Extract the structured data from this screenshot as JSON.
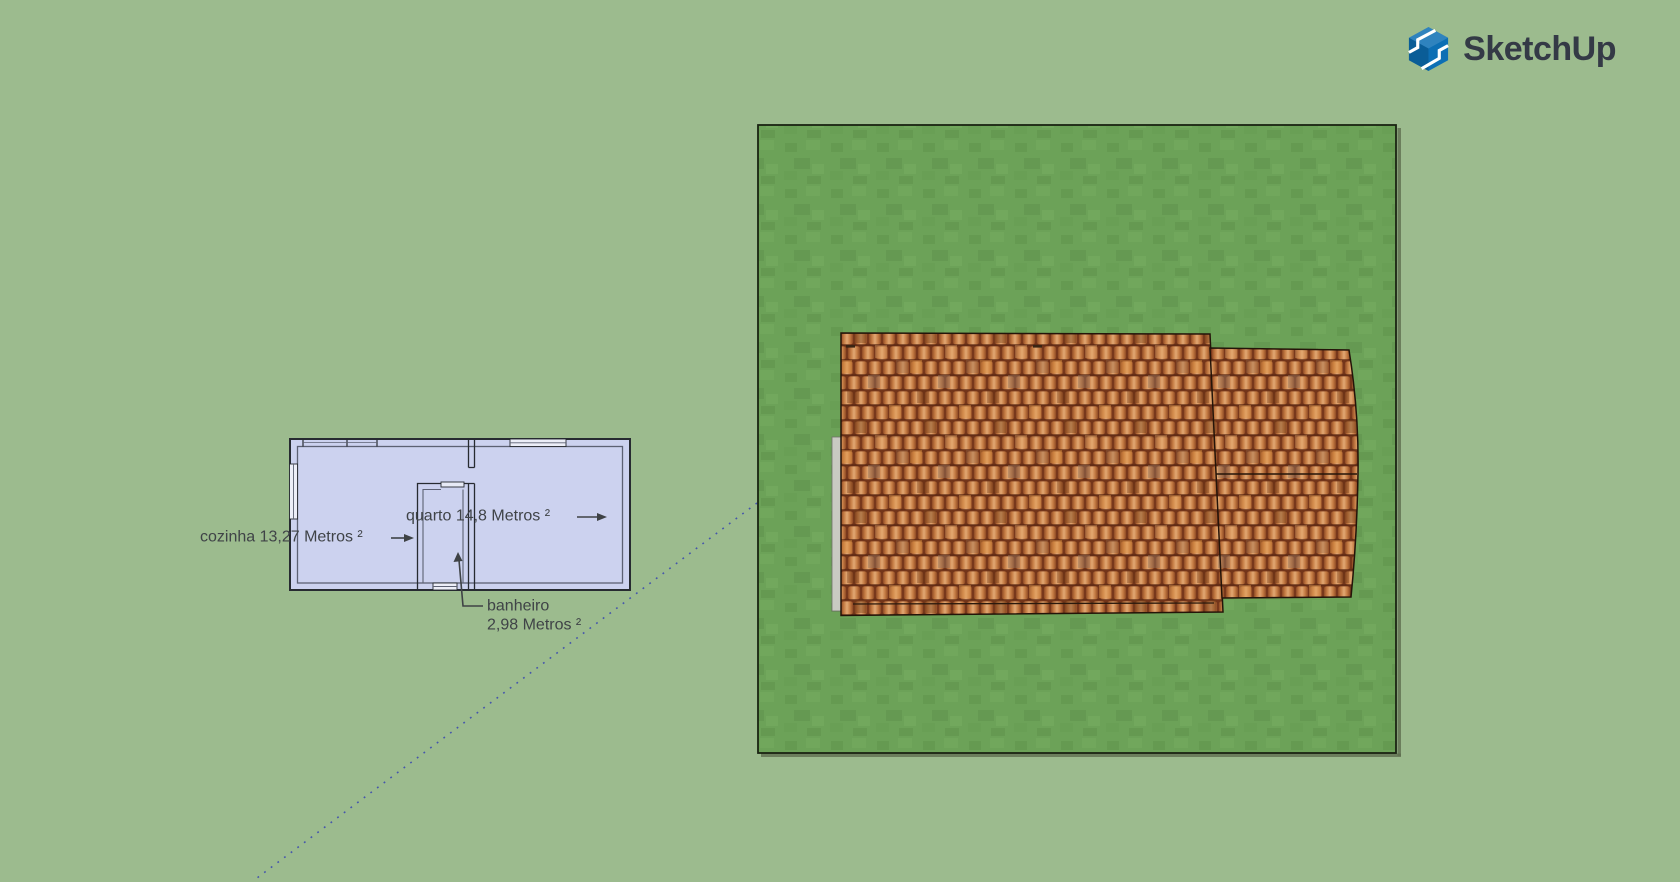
{
  "app": {
    "brand": "SketchUp"
  },
  "viewport": {
    "background_color": "#9cbb8e",
    "guide_line_color": "#4656ab"
  },
  "floorplan": {
    "fill_color": "#ccd2ef",
    "wall_color": "#272b31",
    "labels": {
      "cozinha": "cozinha 13,27 Metros ²",
      "quarto": "quarto 14,8 Metros ²",
      "banheiro_name": "banheiro",
      "banheiro_area": "2,98 Metros ²"
    }
  },
  "model": {
    "lawn_color": "#6ca258",
    "roof_tile_color": "#b96a33",
    "roof_gap_color": "#73351a"
  },
  "logo": {
    "icon_color": "#0d6fb4",
    "text_color": "#343a46"
  }
}
